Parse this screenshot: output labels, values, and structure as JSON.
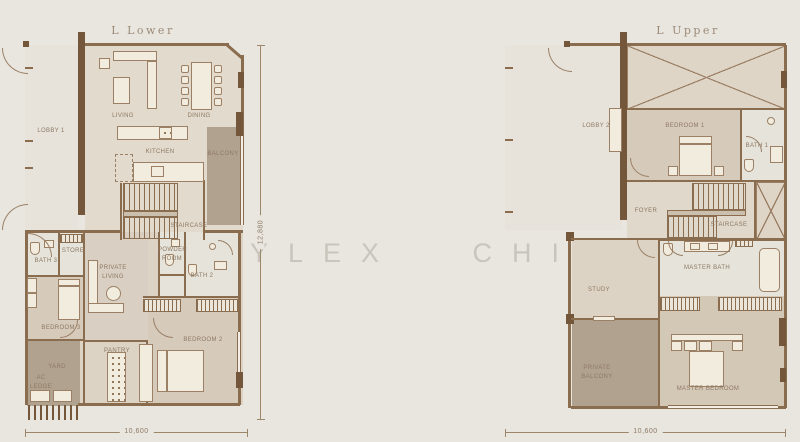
{
  "watermark": "YLEX CHIA",
  "colors": {
    "background": "#e9e6e0",
    "wall": "#8a6c4e",
    "floor_light": "#e2dacd",
    "floor_bedroom": "#d6cabb",
    "floor_bath": "#e5e3da",
    "balcony_dark": "#b1a290",
    "label_text": "#8d7963"
  },
  "lower": {
    "title": "L Lower",
    "dim_width": "10,600",
    "dim_height": "12,880",
    "rooms": {
      "lobby": "LOBBY 1",
      "living": "LIVING",
      "dining": "DINING",
      "kitchen": "KITCHEN",
      "balcony": "BALCONY",
      "staircase": "STAIRCASE",
      "powder": "POWDER ROOM",
      "bath2": "BATH 2",
      "private_living": "PRIVATE LIVING",
      "store": "STORE",
      "bath3": "BATH 3",
      "bedroom3": "BEDROOM 3",
      "yard": "YARD",
      "ac_ledge": "AC LEDGE",
      "pantry": "PANTRY",
      "bedroom2": "BEDROOM 2"
    }
  },
  "upper": {
    "title": "L Upper",
    "dim_width": "10,600",
    "rooms": {
      "lobby": "LOBBY 2",
      "bedroom1": "BEDROOM 1",
      "bath1": "BATH 1",
      "foyer": "FOYER",
      "staircase": "STAIRCASE",
      "master_bath": "MASTER BATH",
      "study": "STUDY",
      "private_balcony": "PRIVATE BALCONY",
      "master_bedroom": "MASTER BEDROOM"
    }
  }
}
